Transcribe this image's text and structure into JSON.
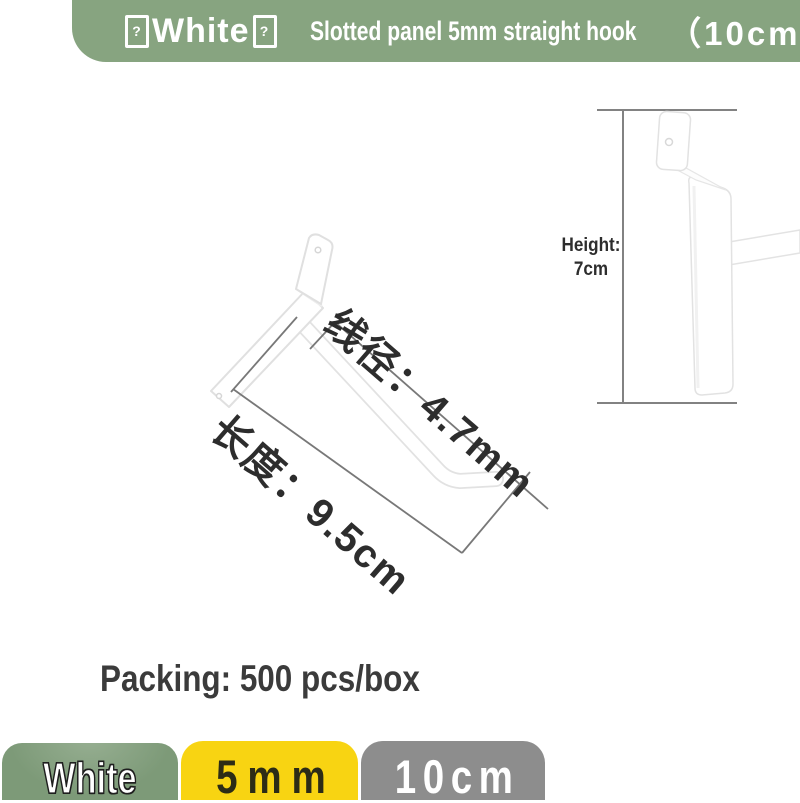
{
  "header": {
    "box_glyph": "?",
    "color_label": "White",
    "product_title": "Slotted panel 5mm straight hook",
    "size_label": "（10cm）",
    "bg_color": "#87a480"
  },
  "diagram": {
    "wire_diameter_label": "线径：4.7mm",
    "length_label": "长度：9.5cm",
    "height_label": "Height:",
    "height_value": "7cm",
    "line_color": "#7a7a7a",
    "hook_color": "#ffffff"
  },
  "packing": {
    "text": "Packing: 500 pcs/box"
  },
  "footer": {
    "swatches": [
      {
        "label": "White",
        "bg": "#7d9a78",
        "text_color": "#ffffff"
      },
      {
        "label": "5mm",
        "bg": "#f8d412",
        "text_color": "#2c2c16"
      },
      {
        "label": "10cm",
        "bg": "#8d8d8d",
        "text_color": "#ffffff"
      }
    ]
  }
}
